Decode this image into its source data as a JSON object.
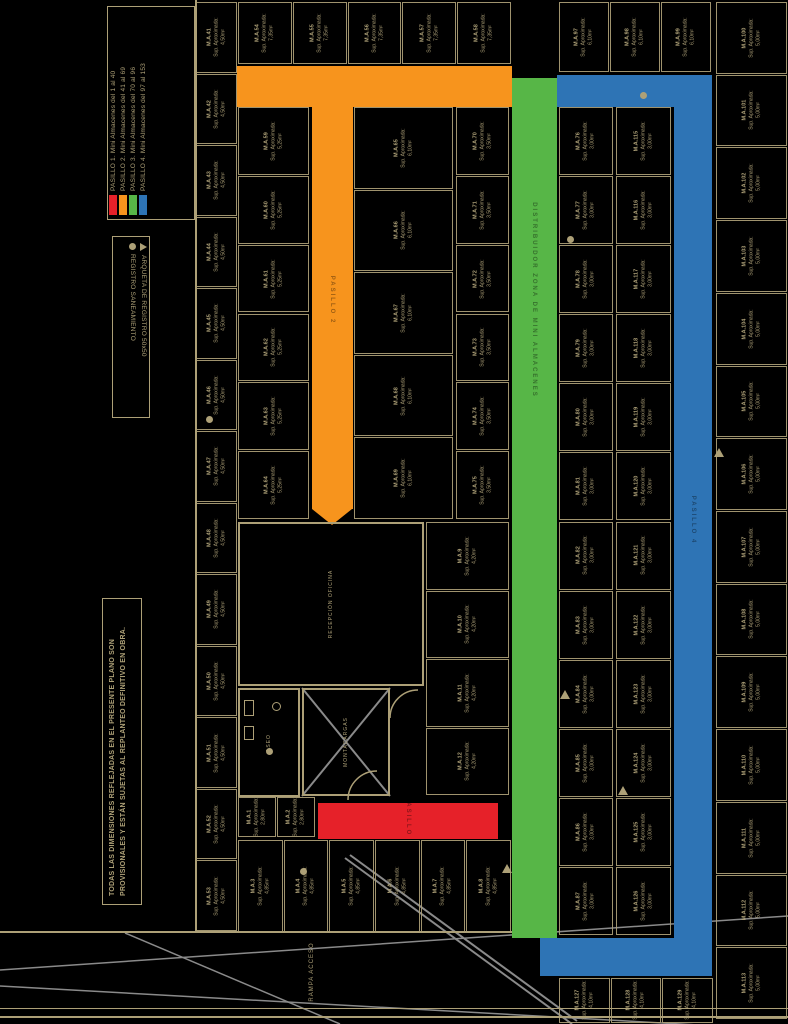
{
  "colors": {
    "background": "#000000",
    "line_tan": "#ADA077",
    "site_gray": "#8A8A8A",
    "red": "#E62129",
    "orange": "#F7941D",
    "green": "#57B647",
    "blue": "#2E74B5"
  },
  "legend_pasillos": {
    "items": [
      {
        "label": "PASILLO 1. Mini Almacenes del 1 al 40",
        "color": "#E62129"
      },
      {
        "label": "PASILLO 2. Mini Almacenes del 41 al 69",
        "color": "#F7941D"
      },
      {
        "label": "PASILLO 3. Mini Almacenes del 70 al 96",
        "color": "#57B647"
      },
      {
        "label": "PASILLO 4. Mini Almacenes del 97 al 153",
        "color": "#2E74B5"
      }
    ]
  },
  "legend_symbols": {
    "items": [
      {
        "icon": "triangle-icon",
        "label": "ARQUETA DE REGISTRO 50x50"
      },
      {
        "icon": "circle-icon",
        "label": "REGISTRO SANEAMIENTO"
      }
    ]
  },
  "note": "TODAS LAS DIMENSIONES REFLEJADAS EN EL PRESENTE PLANO SON PROVISIONALES Y ESTÁN SUJETAS AL REPLANTEO DEFINITIVO EN OBRA.",
  "site": {
    "ramp_label": "RAMPA ACCESO"
  },
  "corridors": [
    {
      "id": "pasillo-2",
      "label": "PASILLO 2",
      "color": "#F7941D",
      "rects": [
        {
          "x": 237,
          "y": 66,
          "w": 275,
          "h": 41
        },
        {
          "x": 312,
          "y": 107,
          "w": 41,
          "h": 402
        }
      ],
      "arrow": {
        "x": 312,
        "y": 509,
        "w": 41,
        "h": 16
      },
      "label_x": 332,
      "label_y": 300
    },
    {
      "id": "pasillo-3",
      "label": "DISTRIBUIDOR ZONA DE MINI ALMACENES",
      "color": "#57B647",
      "rects": [
        {
          "x": 512,
          "y": 78,
          "w": 45,
          "h": 860
        }
      ],
      "label_x": 534,
      "label_y": 300
    },
    {
      "id": "pasillo-4",
      "label": "PASILLO 4",
      "color": "#2E74B5",
      "rects": [
        {
          "x": 557,
          "y": 75,
          "w": 155,
          "h": 32
        },
        {
          "x": 674,
          "y": 75,
          "w": 38,
          "h": 901
        },
        {
          "x": 540,
          "y": 938,
          "w": 134,
          "h": 38
        }
      ],
      "label_x": 693,
      "label_y": 520
    },
    {
      "id": "pasillo-1",
      "label": "PASILLO 1",
      "color": "#E62129",
      "rects": [
        {
          "x": 318,
          "y": 803,
          "w": 180,
          "h": 36
        }
      ],
      "label_x": 408,
      "label_y": 821
    }
  ],
  "rooms": [
    {
      "id": "recepcion",
      "label": "RECEPCIÓN OFICINA",
      "x": 238,
      "y": 522,
      "w": 186,
      "h": 164
    },
    {
      "id": "montacargas",
      "label": "MONTACARGAS",
      "x": 302,
      "y": 688,
      "w": 88,
      "h": 108
    },
    {
      "id": "aseo",
      "label": "ASEO",
      "x": 238,
      "y": 688,
      "w": 62,
      "h": 109
    }
  ],
  "units": {
    "prefix": "M.A.",
    "sup_label": "Sup. Aproximada:",
    "strips": [
      {
        "id": "left-outer",
        "x": 196,
        "y": 2,
        "w": 42,
        "h": 930,
        "count": 13,
        "dir": "v",
        "start": 41,
        "area": "4,50m²"
      },
      {
        "id": "top-row",
        "x": 238,
        "y": 2,
        "w": 274,
        "h": 63,
        "count": 5,
        "dir": "h",
        "start": 54,
        "area": "7,35m²"
      },
      {
        "id": "left-inner",
        "x": 238,
        "y": 107,
        "w": 72,
        "h": 413,
        "count": 6,
        "dir": "v",
        "start": 59,
        "area": "5,25m²"
      },
      {
        "id": "mid-col",
        "x": 354,
        "y": 107,
        "w": 100,
        "h": 413,
        "count": 5,
        "dir": "v",
        "start": 65,
        "area": "6,10m²"
      },
      {
        "id": "pre-green",
        "x": 456,
        "y": 107,
        "w": 54,
        "h": 413,
        "count": 6,
        "dir": "v",
        "start": 70,
        "area": "3,50m²"
      },
      {
        "id": "center-right",
        "x": 426,
        "y": 522,
        "w": 84,
        "h": 274,
        "count": 4,
        "dir": "v",
        "start": 9,
        "area": "4,20m²"
      },
      {
        "id": "green-side",
        "x": 559,
        "y": 107,
        "w": 55,
        "h": 829,
        "count": 12,
        "dir": "v",
        "start": 76,
        "area": "3,00m²"
      },
      {
        "id": "blue-inner",
        "x": 616,
        "y": 107,
        "w": 56,
        "h": 829,
        "count": 12,
        "dir": "v",
        "start": 115,
        "area": "3,00m²"
      },
      {
        "id": "top-right-row",
        "x": 559,
        "y": 2,
        "w": 153,
        "h": 71,
        "count": 3,
        "dir": "h",
        "start": 97,
        "area": "6,10m²"
      },
      {
        "id": "right-outer",
        "x": 716,
        "y": 2,
        "w": 72,
        "h": 1018,
        "count": 14,
        "dir": "v",
        "start": 100,
        "area": "5,00m²"
      },
      {
        "id": "bottom-blue-row",
        "x": 559,
        "y": 978,
        "w": 155,
        "h": 46,
        "count": 3,
        "dir": "h",
        "start": 127,
        "area": "4,10m²"
      },
      {
        "id": "bottom-row",
        "x": 238,
        "y": 840,
        "w": 274,
        "h": 93,
        "count": 6,
        "dir": "h",
        "start": 3,
        "area": "4,85m²"
      },
      {
        "id": "red-end",
        "x": 238,
        "y": 797,
        "w": 78,
        "h": 41,
        "count": 2,
        "dir": "h",
        "start": 1,
        "area": "2,80m²"
      }
    ]
  },
  "walls": [
    {
      "x": 195,
      "y": 0,
      "w": 2,
      "h": 933
    },
    {
      "x": 0,
      "y": 931,
      "w": 540,
      "h": 2
    },
    {
      "x": 0,
      "y": 1008,
      "w": 788,
      "h": 1
    },
    {
      "x": 0,
      "y": 1016,
      "w": 788,
      "h": 2
    }
  ],
  "markers": {
    "circles": [
      {
        "x": 206,
        "y": 416
      },
      {
        "x": 266,
        "y": 748
      },
      {
        "x": 567,
        "y": 236
      },
      {
        "x": 640,
        "y": 92
      },
      {
        "x": 300,
        "y": 868
      }
    ],
    "triangles": [
      {
        "x": 714,
        "y": 448
      },
      {
        "x": 618,
        "y": 786
      },
      {
        "x": 502,
        "y": 864
      },
      {
        "x": 560,
        "y": 690
      }
    ],
    "fixtures": [
      {
        "x": 244,
        "y": 700,
        "w": 10,
        "h": 16
      },
      {
        "x": 244,
        "y": 726,
        "w": 10,
        "h": 14
      },
      {
        "x": 272,
        "y": 702,
        "w": 9,
        "h": 9
      }
    ]
  }
}
